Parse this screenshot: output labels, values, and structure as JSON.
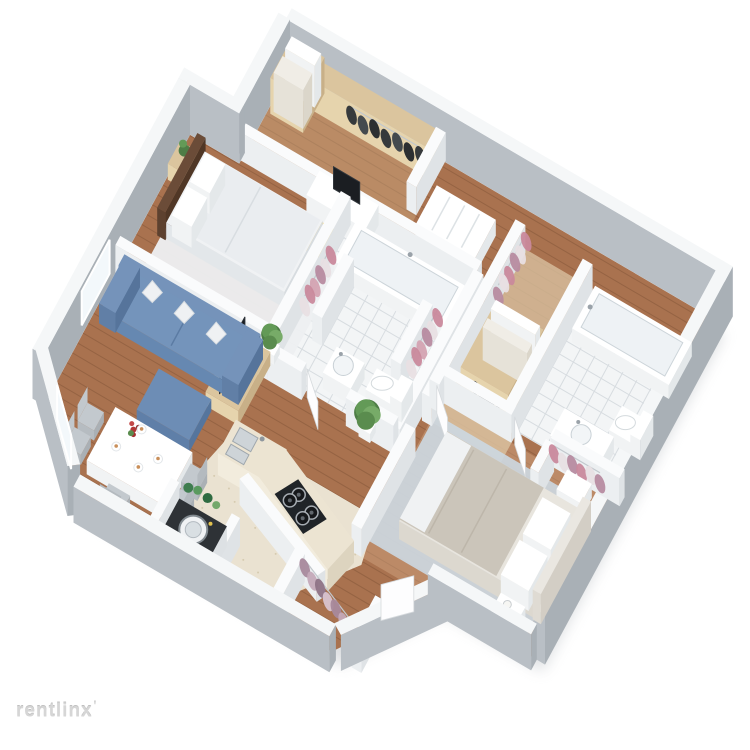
{
  "watermark": {
    "text": "rentlinx",
    "tick": "'"
  },
  "floorplan": {
    "type": "3d-isometric-floor-plan-rendering",
    "rooms": [
      {
        "name": "walk-in-closet",
        "furniture": [
          "wood shelving",
          "stacked storage boxes",
          "dark hanging clothes",
          "open door"
        ]
      },
      {
        "name": "bedroom-1",
        "furniture": [
          "double bed with white bedding",
          "dark headboard",
          "nightstand with plant",
          "light area rug",
          "desk with monitor",
          "yellow chair"
        ]
      },
      {
        "name": "bathroom-1",
        "furniture": [
          "bathtub",
          "toilet",
          "pedestal sink",
          "two closet niches with pink hanging clothes",
          "white tiled floor"
        ]
      },
      {
        "name": "living-room",
        "furniture": [
          "blue sofa with white pillows",
          "blue ottoman",
          "tv stand",
          "tv",
          "potted plant",
          "window"
        ]
      },
      {
        "name": "dining-area",
        "furniture": [
          "white dining table",
          "five gray chairs",
          "red flower centerpiece",
          "place settings",
          "window"
        ]
      },
      {
        "name": "kitchen",
        "furniture": [
          "l-shaped counter",
          "double sink",
          "four-burner stove",
          "large potted plant"
        ]
      },
      {
        "name": "laundry-nook",
        "furniture": [
          "washing machine",
          "green shelf items"
        ]
      },
      {
        "name": "entry",
        "furniture": [
          "coat closet with mauve hanging clothes",
          "open door"
        ]
      },
      {
        "name": "bedroom-2",
        "furniture": [
          "queen bed with gray duvet",
          "white pillows",
          "two white nightstands",
          "lamp",
          "blue-gray area rug",
          "closet with pink hanging clothes",
          "open door"
        ]
      },
      {
        "name": "bathroom-2",
        "furniture": [
          "bathtub",
          "toilet",
          "sink cabinet",
          "wood wardrobe with shoes",
          "pink hanging clothes",
          "white tiled floor"
        ]
      }
    ],
    "palette": {
      "background": "#ffffff",
      "wallTop": "#f5f7f8",
      "wallFace": "#b9bfc5",
      "wallFaceDark": "#a9b0b6",
      "innerWallTop": "#fafbfc",
      "innerWall": "#eceff1",
      "innerWallDark": "#dfe3e6",
      "wood": "#a9724f",
      "woodLight": "#d9ae8b",
      "tile": "#f3f5f6",
      "tileLine": "#d7dce0",
      "kitchenTile": "#eae2d1",
      "sofa": "#6d8db5",
      "bedding": "#f0f2f4",
      "duvet": "#cbc5ba",
      "rug": "#ccd7df",
      "rugLight": "#edeff1",
      "plant": "#5f9054",
      "clothesPink": "#c9899c",
      "clothesMauve": "#a8899c",
      "clothesDark": "#2c3136",
      "woodFurniture": "#dbc59e",
      "accentYellow": "#eccb5f",
      "tv": "#191c20",
      "stove": "#202428",
      "watermark": "#d6d6d6"
    }
  }
}
